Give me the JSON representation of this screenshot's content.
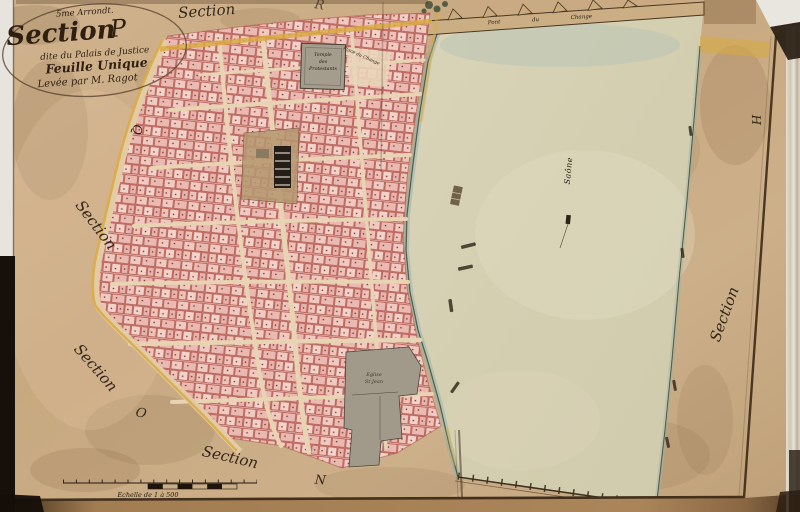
{
  "cartouche": {
    "arrondissement": "5me Arrondt.",
    "title_word": "Section",
    "title_letter": "P",
    "subtitle": "dite du Palais de Justice",
    "sheet": "Feuille Unique",
    "surveyor": "Levée par M. Ragot"
  },
  "labels": {
    "section_top": "Section",
    "letter_top_partial": "R",
    "letter_q": "Q",
    "section_left_upper": "Section",
    "section_left_lower": "Section",
    "letter_o": "O",
    "section_bottom": "Section",
    "letter_n": "N",
    "section_right": "Section",
    "letter_h": "H"
  },
  "map_texts": {
    "river": "Saône",
    "bridge": "Pont du Change",
    "temple_line1": "Temple",
    "temple_line2": "des",
    "temple_line3": "Protestants",
    "place": "Place du Change",
    "church_line1": "Eglise",
    "church_line2": "St Jean",
    "scale": "Echelle de 1 à 500"
  },
  "colors": {
    "paper": "#c9aa82",
    "water": "#d7d1b5",
    "parcel_pink": "#efc6be",
    "parcel_line": "#a8473d",
    "ochre_road": "#d9ab42",
    "ink": "#2a1c10",
    "water_edge": "#567f85",
    "building_gray": "#a49c8d"
  }
}
